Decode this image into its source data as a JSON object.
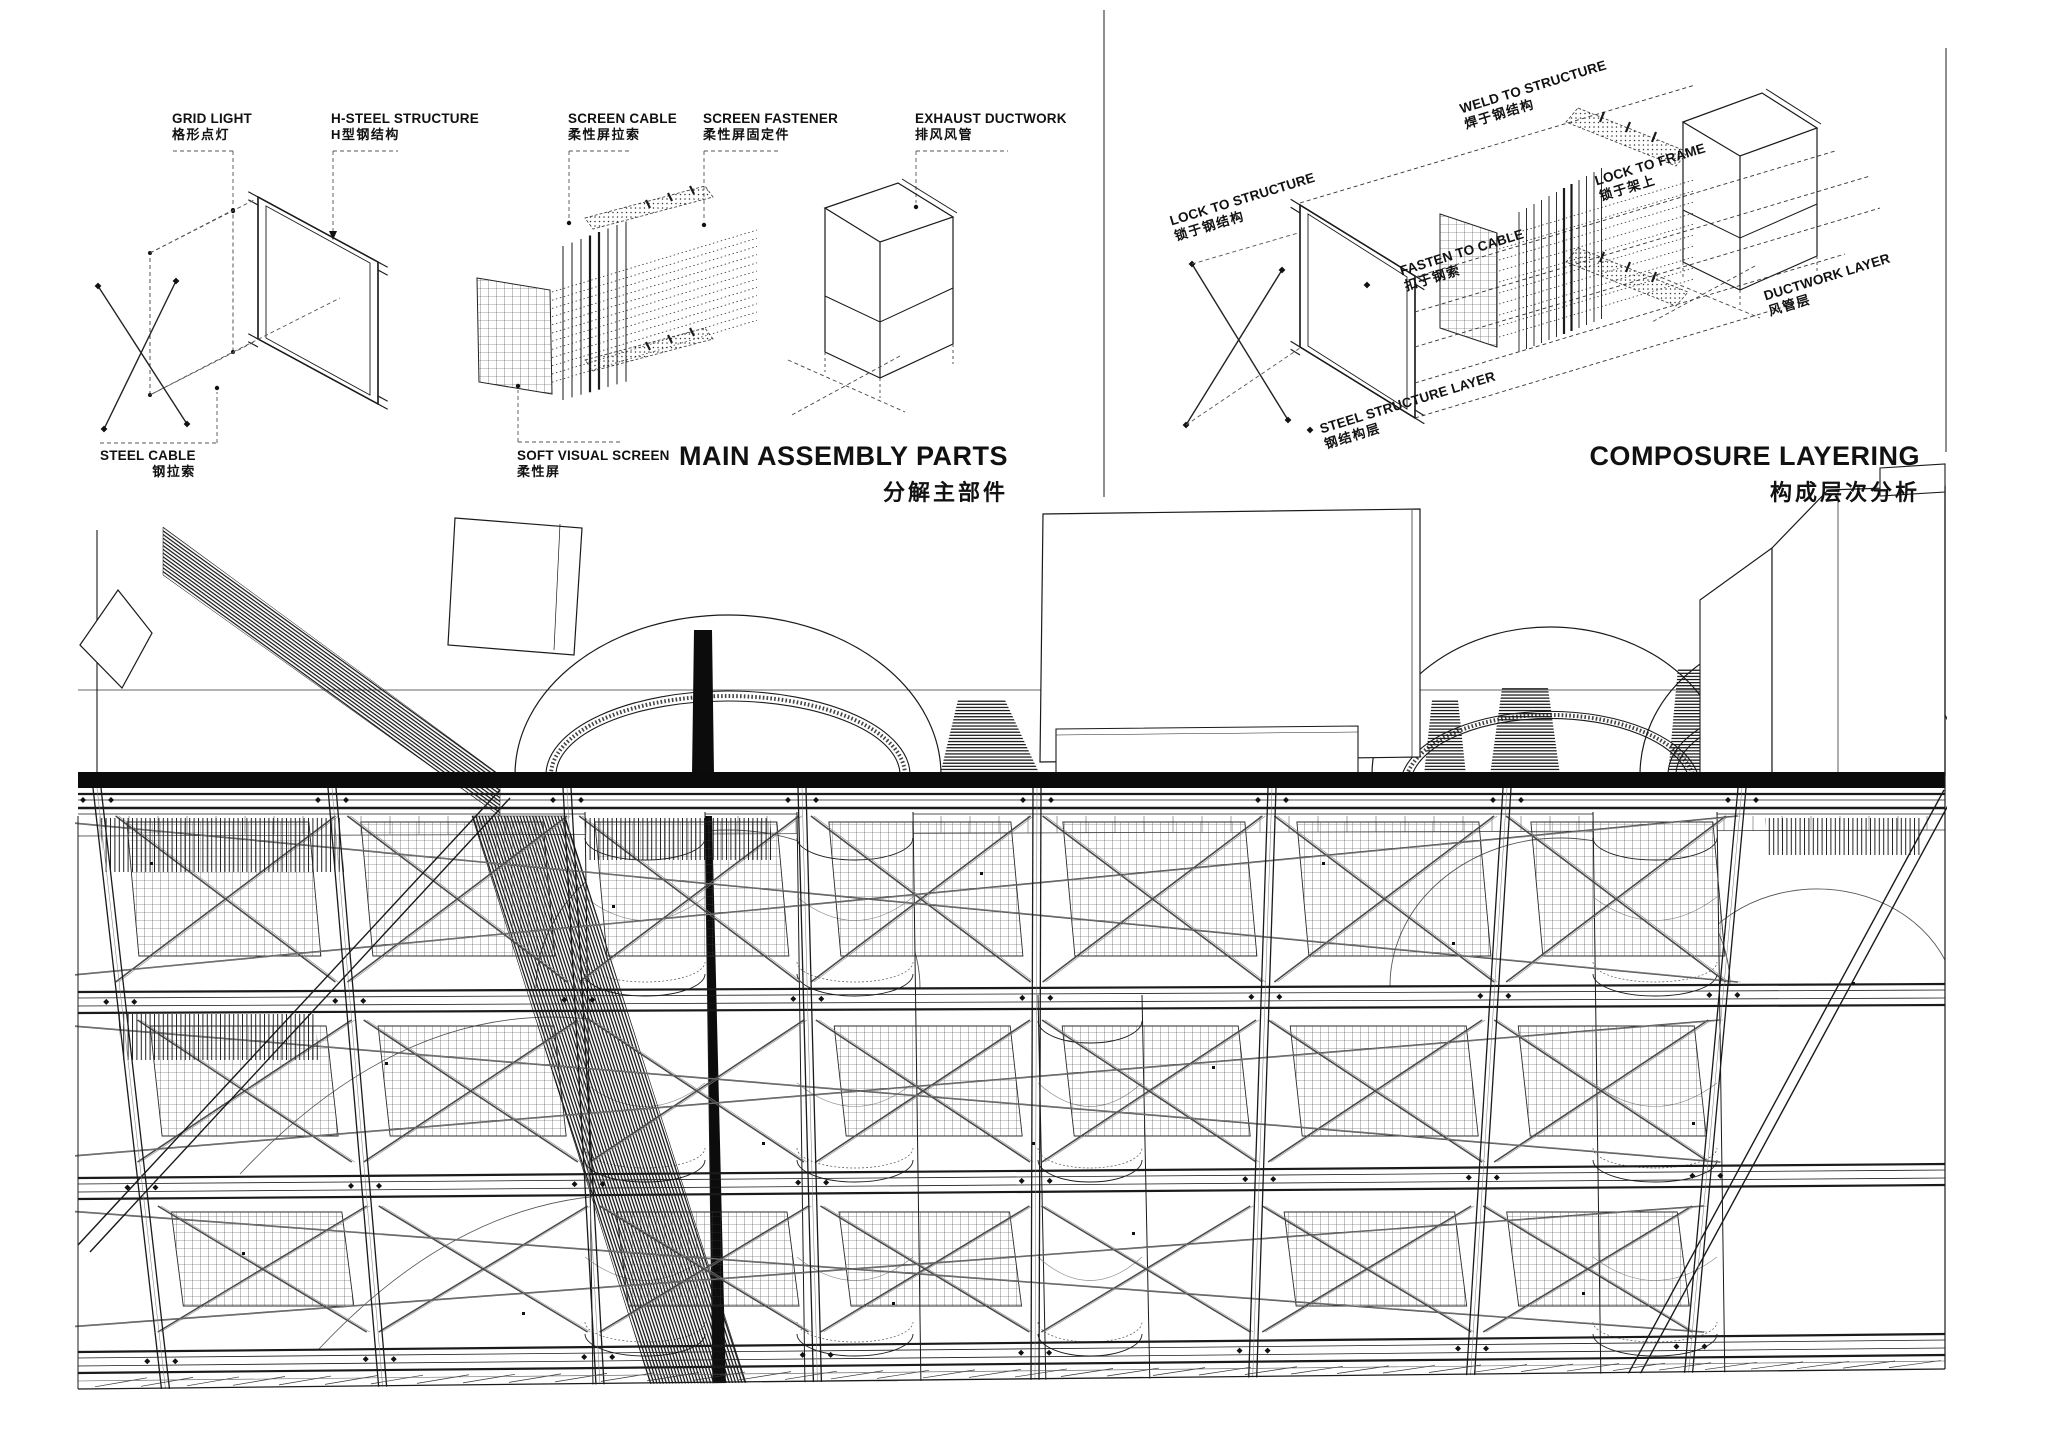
{
  "panels": {
    "left": {
      "title_en": "MAIN ASSEMBLY PARTS",
      "title_zh": "分解主部件",
      "labels": {
        "grid_light": {
          "en": "GRID LIGHT",
          "zh": "格形点灯"
        },
        "h_steel_structure": {
          "en": "H-STEEL STRUCTURE",
          "zh": "H型钢结构"
        },
        "screen_cable": {
          "en": "SCREEN CABLE",
          "zh": "柔性屏拉索"
        },
        "screen_fastener": {
          "en": "SCREEN FASTENER",
          "zh": "柔性屏固定件"
        },
        "exhaust_ductwork": {
          "en": "EXHAUST DUCTWORK",
          "zh": "排风风管"
        },
        "steel_cable": {
          "en": "STEEL CABLE",
          "zh": "钢拉索"
        },
        "soft_visual_screen": {
          "en": "SOFT VISUAL SCREEN",
          "zh": "柔性屏"
        }
      }
    },
    "right": {
      "title_en": "COMPOSURE LAYERING",
      "title_zh": "构成层次分析",
      "labels": {
        "lock_to_structure": {
          "en": "LOCK TO STRUCTURE",
          "zh": "锁于钢结构"
        },
        "weld_to_structure": {
          "en": "WELD TO STRUCTURE",
          "zh": "焊于钢结构"
        },
        "fasten_to_cable": {
          "en": "FASTEN TO CABLE",
          "zh": "扣于钢索"
        },
        "lock_to_frame": {
          "en": "LOCK TO FRAME",
          "zh": "锁于架上"
        },
        "ductwork_layer": {
          "en": "DUCTWORK LAYER",
          "zh": "风管层"
        },
        "steel_structure_layer": {
          "en": "STEEL STRUCTURE LAYER",
          "zh": "钢结构层"
        }
      }
    }
  },
  "colors": {
    "ink": "#1a1a1a",
    "line_gray": "#555555",
    "background": "#ffffff"
  }
}
